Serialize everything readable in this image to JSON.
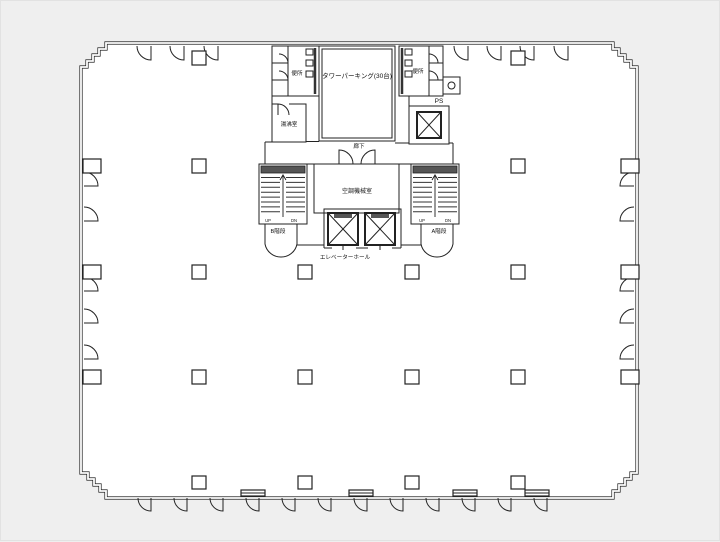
{
  "canvas": {
    "background": "#efefef",
    "floor": "#ffffff",
    "line": "#222222",
    "dark_fill": "#555555"
  },
  "floorplan": {
    "rooms": {
      "tower_parking": "タワーパーキング(30台)",
      "toilet_left": "便所",
      "toilet_right": "便所",
      "hot_water_room": "湯沸室",
      "pipe_shaft": "PS",
      "corridor": "廊下",
      "ac_machine_room": "空調機械室",
      "stair_b": "B階段",
      "stair_a": "A階段",
      "elevator_hall": "エレベーターホール"
    },
    "stair_marks": {
      "up": "UP",
      "dn": "DN"
    }
  }
}
